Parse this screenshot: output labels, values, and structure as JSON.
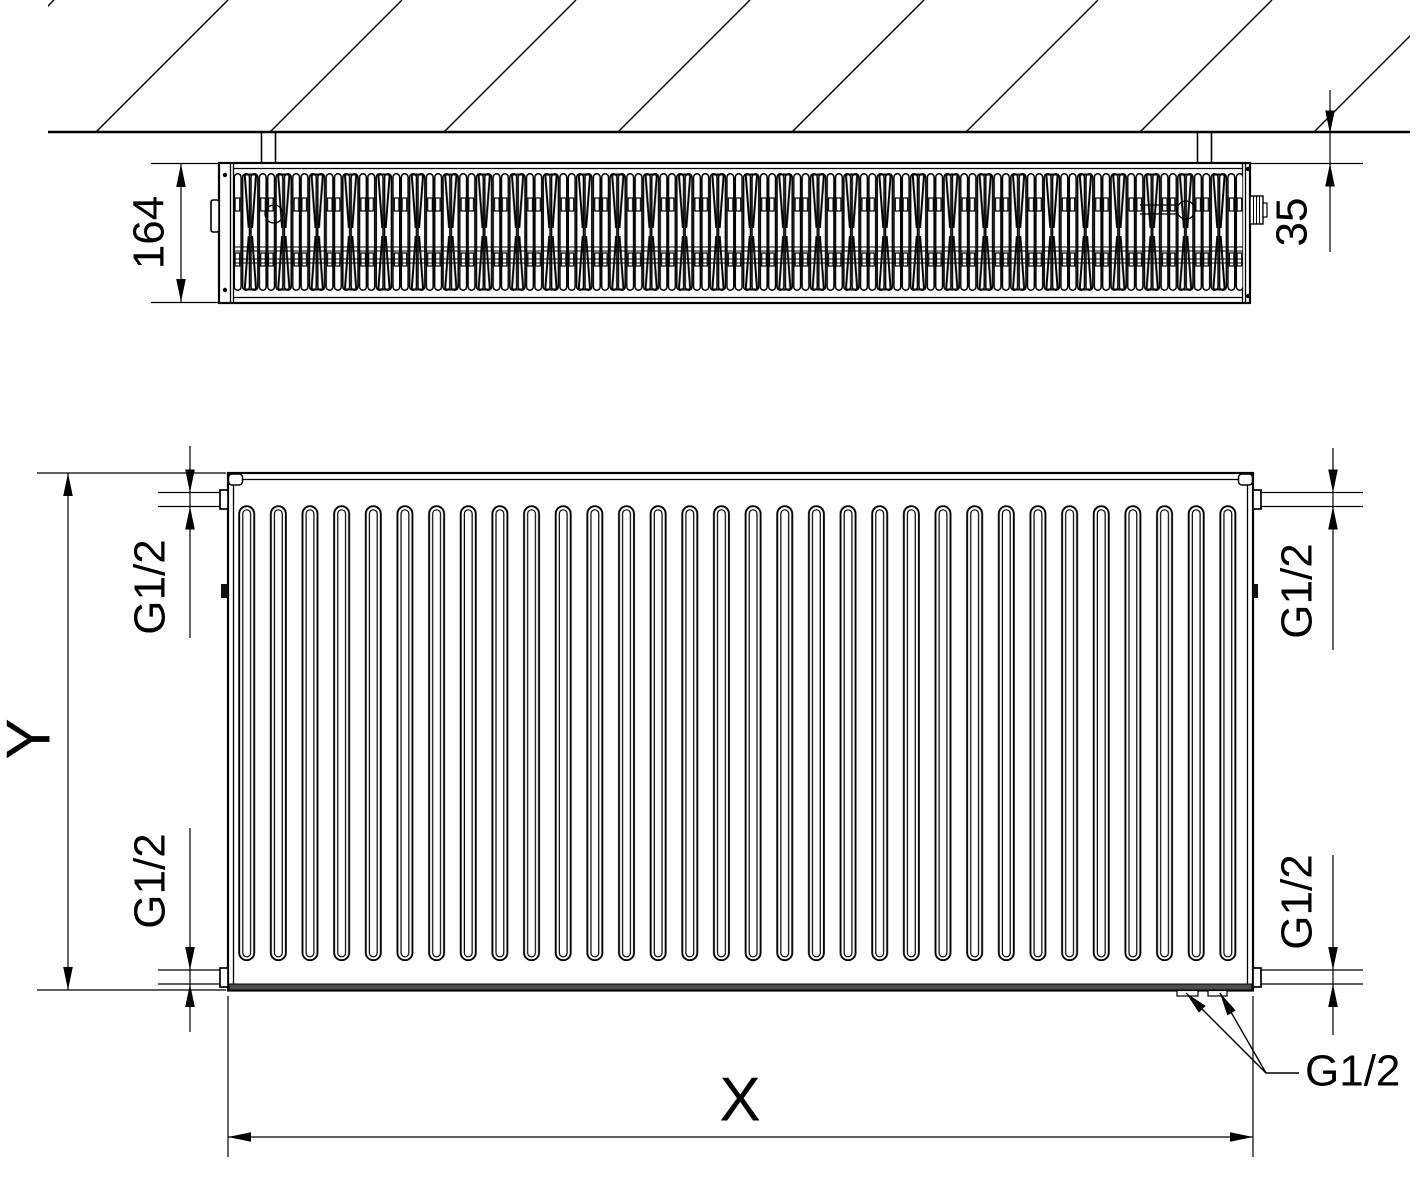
{
  "top_view": {
    "depth_dim": "164",
    "wall_distance_dim": "35"
  },
  "front_view": {
    "height_dim": "Y",
    "width_dim": "X",
    "conn_top_left": "G1/2",
    "conn_top_right": "G1/2",
    "conn_bottom_left": "G1/2",
    "conn_bottom_right": "G1/2",
    "conn_callout": "G1/2"
  },
  "colors": {
    "ink": "#000000",
    "paper": "#ffffff",
    "bottom_band": "#4d4d4d"
  }
}
